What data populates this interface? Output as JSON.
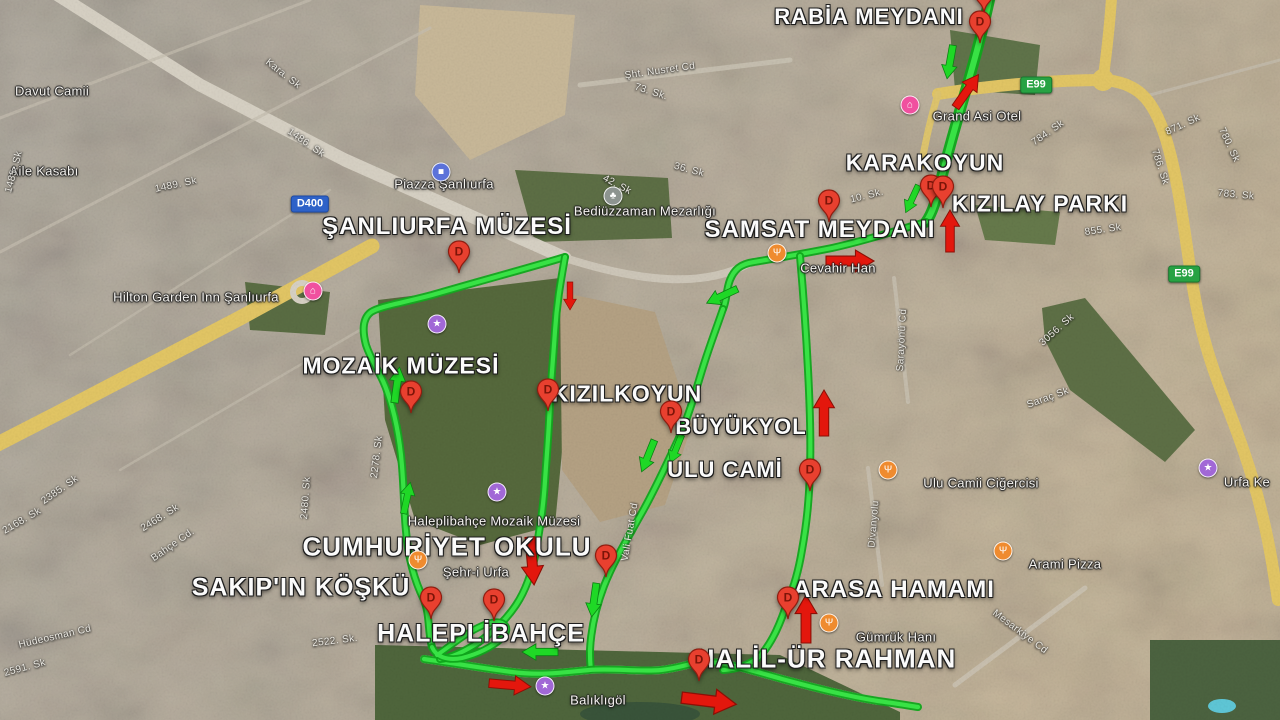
{
  "map": {
    "size": {
      "w": 1280,
      "h": 720
    },
    "marker_letter": "D",
    "colors": {
      "route_green": "#38e245",
      "route_dark": "#0fa51b",
      "arrow_red": "#e3170d",
      "arrow_red_edge": "#8c0f06",
      "arrow_green": "#1fd826",
      "arrow_green_edge": "#0b7e12",
      "badge_blue": "#2e62c8",
      "badge_green": "#27a243",
      "pin_red": "#e8402f",
      "hotel_pink": "#f0509f",
      "restaurant_orange": "#ef8b2f",
      "attraction_purple": "#a168d6",
      "shopping_blue": "#5b72d9",
      "cemetery_gray": "#8d9490"
    },
    "place_labels": [
      {
        "text": "RABİA MEYDANI",
        "x": 869,
        "y": 17,
        "size": 22
      },
      {
        "text": "KARAKOYUN",
        "x": 925,
        "y": 163,
        "size": 23
      },
      {
        "text": "KIZILAY PARKI",
        "x": 1040,
        "y": 204,
        "size": 23
      },
      {
        "text": "SAMSAT MEYDANI",
        "x": 820,
        "y": 230,
        "size": 24
      },
      {
        "text": "ŞANLIURFA MÜZESİ",
        "x": 447,
        "y": 227,
        "size": 24
      },
      {
        "text": "MOZAİK MÜZESİ",
        "x": 401,
        "y": 366,
        "size": 23
      },
      {
        "text": "KIZILKOYUN",
        "x": 627,
        "y": 394,
        "size": 23
      },
      {
        "text": "BÜYÜKYOL",
        "x": 741,
        "y": 427,
        "size": 22
      },
      {
        "text": "ULU CAMİ",
        "x": 725,
        "y": 470,
        "size": 22
      },
      {
        "text": "CUMHURİYET OKULU",
        "x": 447,
        "y": 547,
        "size": 26
      },
      {
        "text": "SAKIP'IN KÖŞKÜ",
        "x": 301,
        "y": 588,
        "size": 25
      },
      {
        "text": "HALEPLİBAHÇE",
        "x": 481,
        "y": 634,
        "size": 25
      },
      {
        "text": "HALİL-ÜR RAHMAN",
        "x": 826,
        "y": 659,
        "size": 26
      },
      {
        "text": "ARASA HAMAMI",
        "x": 894,
        "y": 590,
        "size": 24
      }
    ],
    "small_labels": [
      {
        "text": "Piazza Şanlıurfa",
        "x": 444,
        "y": 184
      },
      {
        "text": "Bediüzzaman Mezarlığı",
        "x": 645,
        "y": 211
      },
      {
        "text": "Hilton Garden Inn Şanlıurfa",
        "x": 196,
        "y": 297
      },
      {
        "text": "Grand Asi Otel",
        "x": 977,
        "y": 116
      },
      {
        "text": "Cevahir Han",
        "x": 838,
        "y": 268
      },
      {
        "text": "Haleplibahçe Mozaik Müzesi",
        "x": 494,
        "y": 521
      },
      {
        "text": "Şehr-i Urfa",
        "x": 476,
        "y": 572
      },
      {
        "text": "Ulu Camii Ciğercisi",
        "x": 981,
        "y": 483
      },
      {
        "text": "Arami Pizza",
        "x": 1065,
        "y": 564
      },
      {
        "text": "Gümrük Hanı",
        "x": 896,
        "y": 637
      },
      {
        "text": "Balıklıgöl",
        "x": 598,
        "y": 700
      },
      {
        "text": "Urfa Ke",
        "x": 1247,
        "y": 482
      },
      {
        "text": "Aile Kasabı",
        "x": 44,
        "y": 171
      },
      {
        "text": "Davut Camii",
        "x": 52,
        "y": 91
      }
    ],
    "street_labels": [
      {
        "text": "Kara. Sk",
        "x": 283,
        "y": 74,
        "rot": 38
      },
      {
        "text": "1486. Sk",
        "x": 306,
        "y": 143,
        "rot": 35
      },
      {
        "text": "1489. Sk",
        "x": 176,
        "y": 185,
        "rot": -12
      },
      {
        "text": "1485. Sk",
        "x": 14,
        "y": 172,
        "rot": -75
      },
      {
        "text": "Şht. Nusret Cd",
        "x": 660,
        "y": 71,
        "rot": -8
      },
      {
        "text": "73. Sk.",
        "x": 651,
        "y": 92,
        "rot": 18
      },
      {
        "text": "42. Sk",
        "x": 617,
        "y": 185,
        "rot": 28
      },
      {
        "text": "36. Sk",
        "x": 689,
        "y": 170,
        "rot": 15
      },
      {
        "text": "10. Sk.",
        "x": 867,
        "y": 196,
        "rot": -14
      },
      {
        "text": "855. Sk",
        "x": 1103,
        "y": 230,
        "rot": -8
      },
      {
        "text": "784. Sk",
        "x": 1048,
        "y": 133,
        "rot": -35
      },
      {
        "text": "871. Sk",
        "x": 1183,
        "y": 125,
        "rot": -25
      },
      {
        "text": "780. Sk",
        "x": 1229,
        "y": 145,
        "rot": 65
      },
      {
        "text": "786. Sk",
        "x": 1160,
        "y": 167,
        "rot": 72
      },
      {
        "text": "783. Sk",
        "x": 1236,
        "y": 195,
        "rot": 5
      },
      {
        "text": "2385. Sk",
        "x": 60,
        "y": 490,
        "rot": -35
      },
      {
        "text": "2168. Sk",
        "x": 22,
        "y": 521,
        "rot": -30
      },
      {
        "text": "2468. Sk",
        "x": 160,
        "y": 518,
        "rot": -32
      },
      {
        "text": "Bahçe Cd.",
        "x": 173,
        "y": 545,
        "rot": -35
      },
      {
        "text": "Hüdeosman Cd",
        "x": 55,
        "y": 637,
        "rot": -13
      },
      {
        "text": "2591. Sk",
        "x": 25,
        "y": 668,
        "rot": -15
      },
      {
        "text": "2522. Sk.",
        "x": 335,
        "y": 641,
        "rot": -7
      },
      {
        "text": "2480. Sk",
        "x": 306,
        "y": 498,
        "rot": -86
      },
      {
        "text": "2278. Sk",
        "x": 377,
        "y": 457,
        "rot": -83
      },
      {
        "text": "Vali Fuat Cd",
        "x": 630,
        "y": 532,
        "rot": -80
      },
      {
        "text": "Divanyolu",
        "x": 874,
        "y": 524,
        "rot": -85
      },
      {
        "text": "Sarayönü Cd",
        "x": 902,
        "y": 340,
        "rot": -87
      },
      {
        "text": "Mesarkiye Cd",
        "x": 1020,
        "y": 632,
        "rot": 37
      },
      {
        "text": "Saraç Sk",
        "x": 1048,
        "y": 398,
        "rot": -20
      },
      {
        "text": "3056. Sk",
        "x": 1057,
        "y": 330,
        "rot": -42
      }
    ],
    "road_badges": [
      {
        "text": "D400",
        "x": 310,
        "y": 204,
        "style": "blue"
      },
      {
        "text": "E99",
        "x": 1036,
        "y": 85,
        "style": "green"
      },
      {
        "text": "E99",
        "x": 1184,
        "y": 274,
        "style": "green"
      }
    ],
    "markers": [
      {
        "x": 984,
        "y": -8
      },
      {
        "x": 980,
        "y": 22
      },
      {
        "x": 931,
        "y": 186
      },
      {
        "x": 943,
        "y": 187
      },
      {
        "x": 829,
        "y": 201
      },
      {
        "x": 459,
        "y": 252
      },
      {
        "x": 411,
        "y": 392
      },
      {
        "x": 548,
        "y": 390
      },
      {
        "x": 671,
        "y": 412
      },
      {
        "x": 810,
        "y": 470
      },
      {
        "x": 606,
        "y": 556
      },
      {
        "x": 431,
        "y": 598
      },
      {
        "x": 494,
        "y": 600
      },
      {
        "x": 788,
        "y": 598
      },
      {
        "x": 699,
        "y": 660
      }
    ],
    "poi_icons": [
      {
        "name": "hotel-icon",
        "type": "hotel",
        "glyph": "⌂",
        "x": 910,
        "y": 105
      },
      {
        "name": "hotel-icon",
        "type": "hotel",
        "glyph": "⌂",
        "x": 313,
        "y": 291
      },
      {
        "name": "shopping-icon",
        "type": "shopping",
        "glyph": "■",
        "x": 441,
        "y": 172
      },
      {
        "name": "cemetery-icon",
        "type": "cemetery",
        "glyph": "♣",
        "x": 613,
        "y": 196
      },
      {
        "name": "restaurant-icon",
        "type": "restaurant",
        "glyph": "Ψ",
        "x": 777,
        "y": 253
      },
      {
        "name": "restaurant-icon",
        "type": "restaurant",
        "glyph": "Ψ",
        "x": 418,
        "y": 560
      },
      {
        "name": "restaurant-icon",
        "type": "restaurant",
        "glyph": "Ψ",
        "x": 888,
        "y": 470
      },
      {
        "name": "restaurant-icon",
        "type": "restaurant",
        "glyph": "Ψ",
        "x": 1003,
        "y": 551
      },
      {
        "name": "restaurant-icon",
        "type": "restaurant",
        "glyph": "Ψ",
        "x": 829,
        "y": 623
      },
      {
        "name": "attraction-icon",
        "type": "attraction",
        "glyph": "★",
        "x": 497,
        "y": 492
      },
      {
        "name": "attraction-icon",
        "type": "attraction",
        "glyph": "★",
        "x": 545,
        "y": 686
      },
      {
        "name": "attraction-icon",
        "type": "attraction",
        "glyph": "★",
        "x": 1208,
        "y": 468
      },
      {
        "name": "attraction-icon",
        "type": "attraction",
        "glyph": "★",
        "x": 437,
        "y": 324
      }
    ],
    "route": {
      "segments": [
        {
          "d": "M 991 -8 C 983 30 974 62 963 100 C 952 138 946 160 941 180 C 936 200 933 212 926 222",
          "w": 6
        },
        {
          "d": "M 926 222 C 898 230 868 240 832 248 C 802 254 778 258 754 262 C 740 264 734 270 730 280 C 726 290 727 300 723 309",
          "w": 4.2
        },
        {
          "d": "M 723 309 C 715 332 710 345 704 364 C 697 386 689 416 678 440 C 667 463 654 492 640 516 C 625 543 613 563 604 586 C 596 607 591 630 590 650 C 590 658 590 664 591 669",
          "w": 4.2
        },
        {
          "d": "M 800 256 C 803 290 806 330 808 370 C 810 408 811 440 810 470 C 809 500 807 522 802 550 C 798 574 793 589 788 600 C 781 622 773 641 761 655 C 751 665 737 669 723 670",
          "w": 4.2
        },
        {
          "d": "M 424 659 C 452 663 482 668 512 672 C 542 676 566 672 589 670 C 612 668 640 672 661 670 C 680 668 691 663 701 662 C 722 661 743 668 782 679 C 812 687 846 696 878 701 C 893 703 905 705 918 707",
          "w": 4.2
        },
        {
          "d": "M 565 257 C 532 267 480 281 432 295 C 402 303 381 306 371 312 C 363 318 362 330 366 345 C 372 363 381 373 387 391 C 396 416 400 441 402 466 C 404 491 404 511 406 531 C 408 556 414 580 424 600 C 430 615 428 634 432 647",
          "w": 4.2
        },
        {
          "d": "M 565 257 C 561 280 557 301 555 331 C 553 361 551 381 550 401 C 549 431 547 451 545 481 C 543 511 540 526 536 551 C 532 573 526 590 516 605 C 506 620 493 632 479 642 C 464 652 450 658 440 659",
          "w": 4.2
        },
        {
          "d": "M 432 647 C 436 657 448 661 462 658 C 478 654 492 647 502 638 C 508 632 508 626 502 623 C 494 620 482 625 470 632 C 458 639 445 650 437 655",
          "w": 4
        }
      ]
    },
    "arrows": {
      "red": [
        {
          "x": 967,
          "y": 91,
          "rot": 35,
          "len": 40
        },
        {
          "x": 950,
          "y": 231,
          "rot": 0,
          "len": 42
        },
        {
          "x": 850,
          "y": 261,
          "rot": 90,
          "len": 48
        },
        {
          "x": 570,
          "y": 296,
          "rot": 180,
          "len": 28
        },
        {
          "x": 824,
          "y": 413,
          "rot": 0,
          "len": 46
        },
        {
          "x": 806,
          "y": 619,
          "rot": 0,
          "len": 48
        },
        {
          "x": 532,
          "y": 561,
          "rot": 175,
          "len": 48
        },
        {
          "x": 510,
          "y": 685,
          "rot": 95,
          "len": 42
        },
        {
          "x": 709,
          "y": 701,
          "rot": 97,
          "len": 55
        }
      ],
      "green": [
        {
          "x": 950,
          "y": 62,
          "rot": 190,
          "len": 34
        },
        {
          "x": 912,
          "y": 199,
          "rot": 205,
          "len": 30
        },
        {
          "x": 722,
          "y": 296,
          "rot": 245,
          "len": 34
        },
        {
          "x": 397,
          "y": 385,
          "rot": 8,
          "len": 36
        },
        {
          "x": 407,
          "y": 498,
          "rot": 12,
          "len": 32
        },
        {
          "x": 648,
          "y": 456,
          "rot": 202,
          "len": 34
        },
        {
          "x": 676,
          "y": 449,
          "rot": 202,
          "len": 30
        },
        {
          "x": 594,
          "y": 600,
          "rot": 188,
          "len": 34
        },
        {
          "x": 540,
          "y": 652,
          "rot": 270,
          "len": 36
        }
      ]
    }
  }
}
